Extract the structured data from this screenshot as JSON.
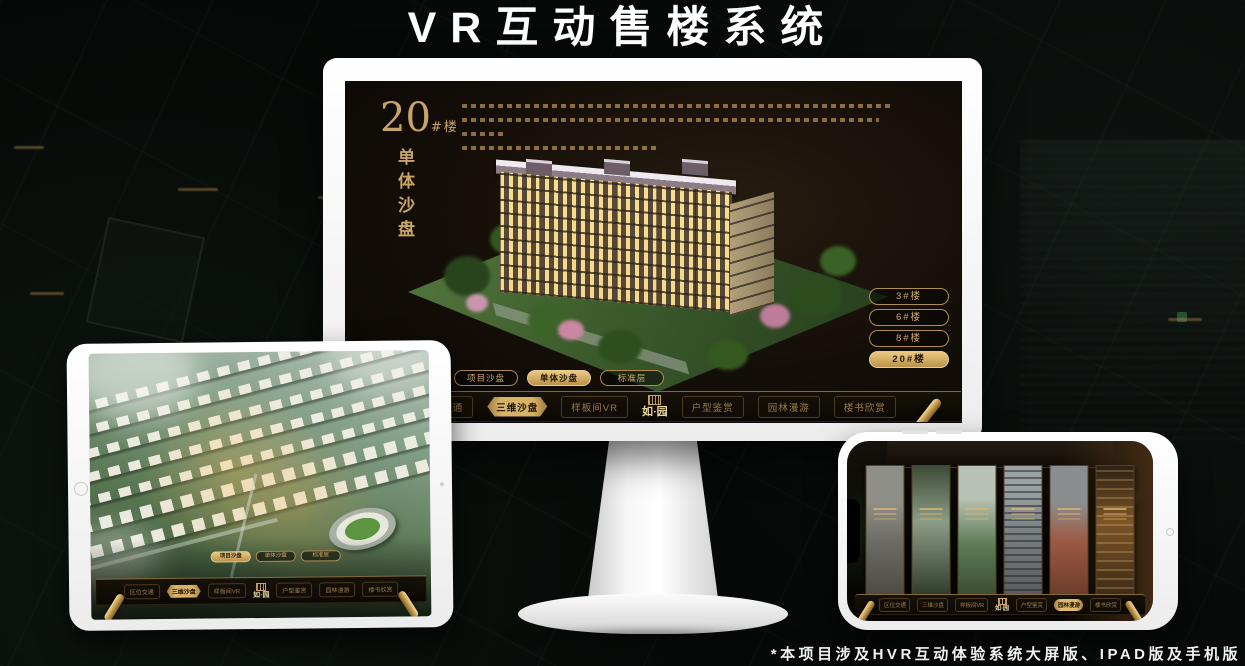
{
  "title": "VR互动售楼系统",
  "footnote": "*本项目涉及HVR互动体验系统大屏版、IPAD版及手机版",
  "brand": {
    "logo_text": "如·园"
  },
  "colors": {
    "gold": "#c9a469",
    "gold_bright": "#ecc983",
    "screen_bg": "#140e08",
    "nav_text": "#977c4c"
  },
  "monitor_ui": {
    "building_number": "20",
    "building_unit": "#楼",
    "building_subtitle": "单体沙盘",
    "floor_buttons": [
      {
        "label": "3#楼",
        "active": false
      },
      {
        "label": "6#楼",
        "active": false
      },
      {
        "label": "8#楼",
        "active": false
      },
      {
        "label": "20#楼",
        "active": true
      }
    ],
    "sub_tabs": [
      {
        "label": "项目沙盘",
        "active": false
      },
      {
        "label": "单体沙盘",
        "active": true
      },
      {
        "label": "标准层",
        "active": false
      }
    ],
    "nav_items": [
      {
        "label": "区位交通",
        "active": false
      },
      {
        "label": "三维沙盘",
        "active": true
      },
      {
        "label": "样板间VR",
        "active": false
      },
      {
        "label": "户型鉴赏",
        "active": false
      },
      {
        "label": "园林漫游",
        "active": false
      },
      {
        "label": "楼书欣赏",
        "active": false
      }
    ]
  },
  "ipad_ui": {
    "sub_tabs": [
      {
        "label": "项目沙盘",
        "active": true
      },
      {
        "label": "单体沙盘",
        "active": false
      },
      {
        "label": "标准层",
        "active": false
      }
    ],
    "nav_items": [
      {
        "label": "区位交通",
        "active": false
      },
      {
        "label": "三维沙盘",
        "active": true
      },
      {
        "label": "样板间VR",
        "active": false
      },
      {
        "label": "户型鉴赏",
        "active": false
      },
      {
        "label": "园林漫游",
        "active": false
      },
      {
        "label": "楼书欣赏",
        "active": false
      }
    ]
  },
  "phone_ui": {
    "nav_items": [
      {
        "label": "区位交通",
        "active": false
      },
      {
        "label": "三维沙盘",
        "active": false
      },
      {
        "label": "样板间VR",
        "active": false
      },
      {
        "label": "户型鉴赏",
        "active": false
      },
      {
        "label": "园林漫游",
        "active": true
      },
      {
        "label": "楼书欣赏",
        "active": false
      }
    ]
  }
}
